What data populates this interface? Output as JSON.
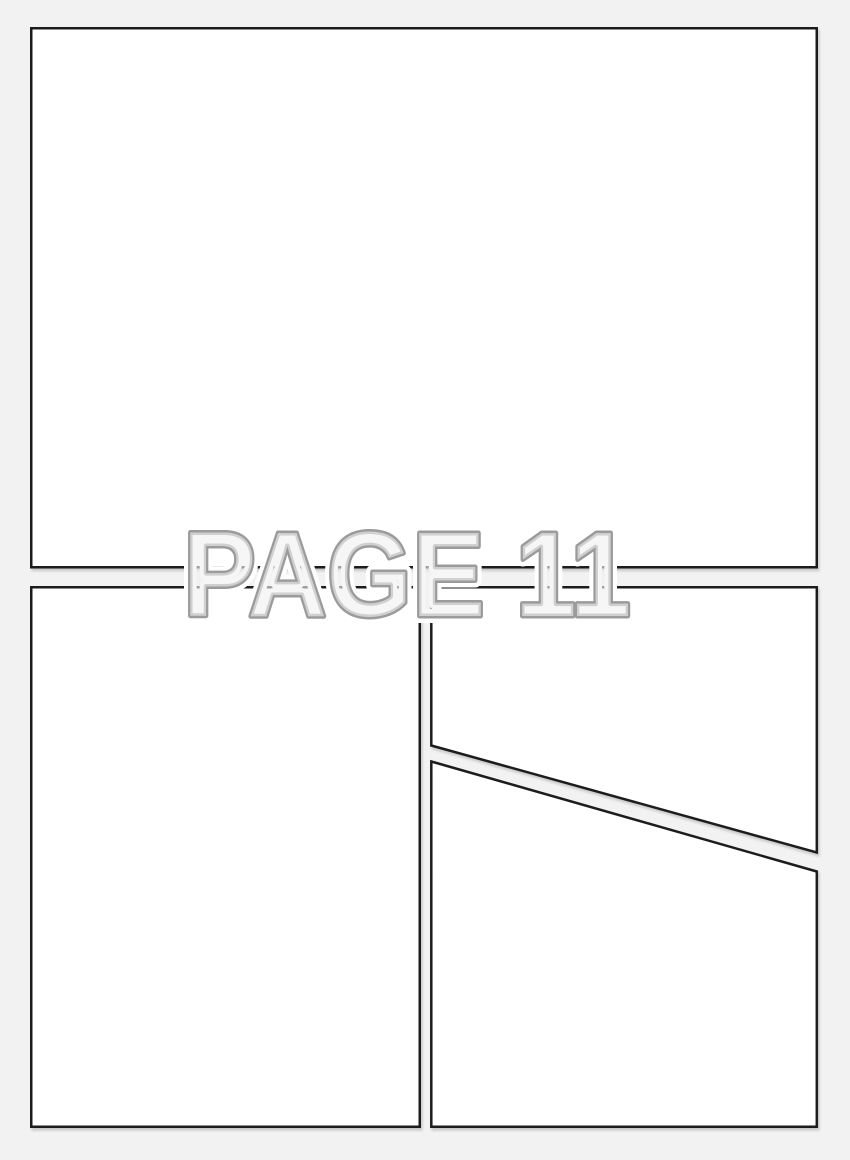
{
  "page": {
    "label": "PAGE 11",
    "panel_count": 4
  },
  "panels": [
    {
      "name": "top-full-width-panel"
    },
    {
      "name": "bottom-left-panel"
    },
    {
      "name": "bottom-right-upper-diagonal-panel"
    },
    {
      "name": "bottom-right-lower-diagonal-panel"
    }
  ],
  "colors": {
    "page_background": "#f2f2f2",
    "panel_fill": "#ffffff",
    "panel_border": "#1f1f1f",
    "label_fill": "#f1f1f1",
    "label_outline": "#9b9b9b",
    "label_halo": "#ffffff"
  }
}
